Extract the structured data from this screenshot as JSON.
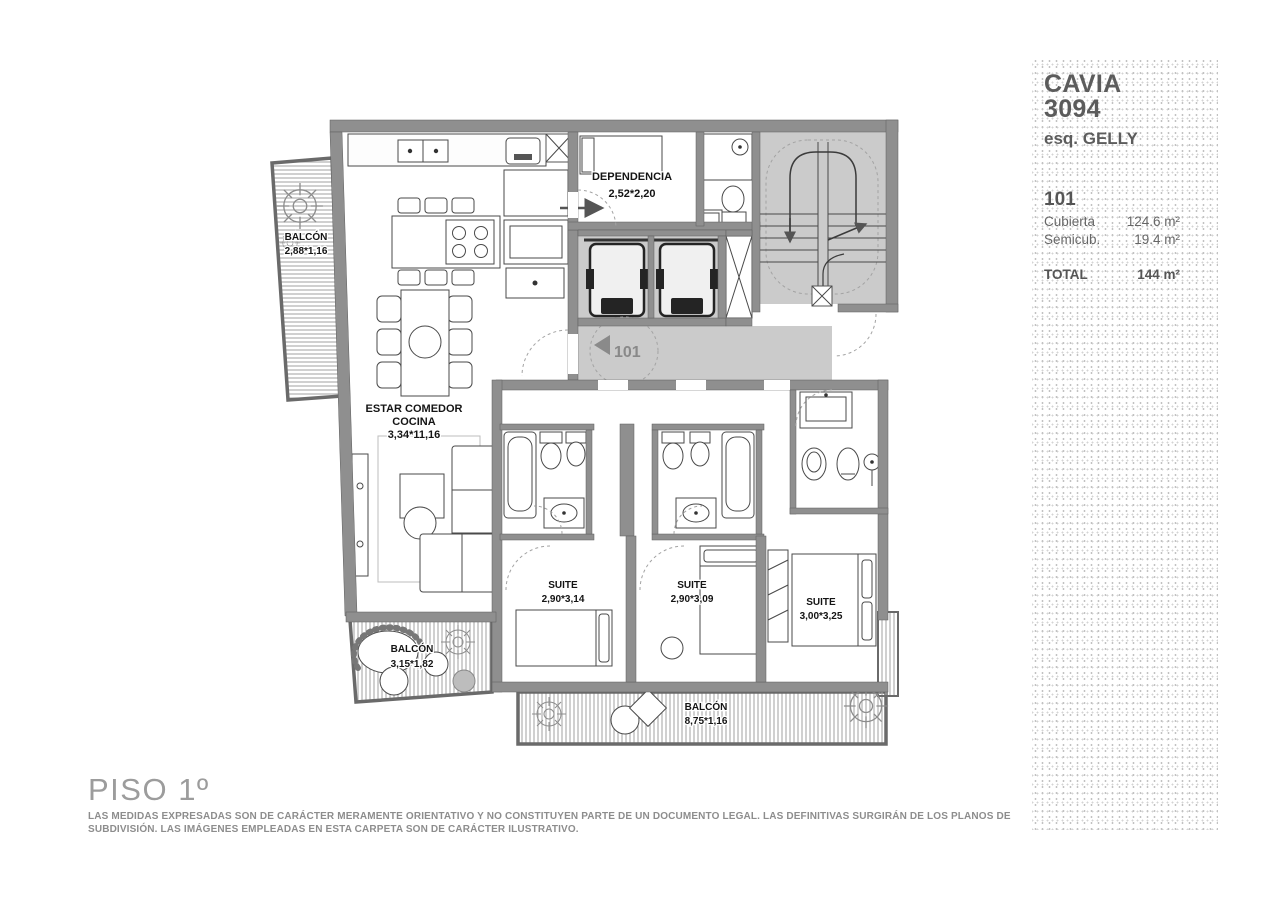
{
  "sidebar": {
    "project": "CAVIA 3094",
    "address": "esq. GELLY",
    "unit": "101",
    "areas": [
      {
        "label": "Cubierta",
        "value": "124.6 m²"
      },
      {
        "label": "Semicub.",
        "value": "19.4 m²"
      }
    ],
    "total_label": "TOTAL",
    "total_value": "144 m²"
  },
  "footer": {
    "floor_title": "PISO 1º",
    "disclaimer": "LAS MEDIDAS EXPRESADAS SON DE CARÁCTER MERAMENTE ORIENTATIVO Y NO CONSTITUYEN PARTE DE UN DOCUMENTO LEGAL. LAS DEFINITIVAS SURGIRÁN DE LOS PLANOS DE SUBDIVISIÓN. LAS IMÁGENES EMPLEADAS EN ESTA CARPETA SON DE CARÁCTER ILUSTRATIVO."
  },
  "plan": {
    "unit_marker": "101",
    "balcony_top": {
      "name": "BALCÓN",
      "dims": "2,88*1,16"
    },
    "dependencia": {
      "name": "DEPENDENCIA",
      "dims": "2,52*2,20"
    },
    "living": {
      "line1": "ESTAR COMEDOR",
      "line2": "COCINA",
      "dims": "3,34*11,16"
    },
    "suite1": {
      "name": "SUITE",
      "dims": "2,90*3,14"
    },
    "suite2": {
      "name": "SUITE",
      "dims": "2,90*3,09"
    },
    "suite3": {
      "name": "SUITE",
      "dims": "3,00*3,25"
    },
    "balcony_left": {
      "name": "BALCÓN",
      "dims": "3,15*1,82"
    },
    "balcony_bottom": {
      "name": "BALCÓN",
      "dims": "8,75*1,16"
    }
  },
  "colors": {
    "wall": "#8f8f8f",
    "circulation_gray": "#cbcbcb",
    "sidebar_text": "#5f5f5f",
    "label_text": "#141414"
  }
}
